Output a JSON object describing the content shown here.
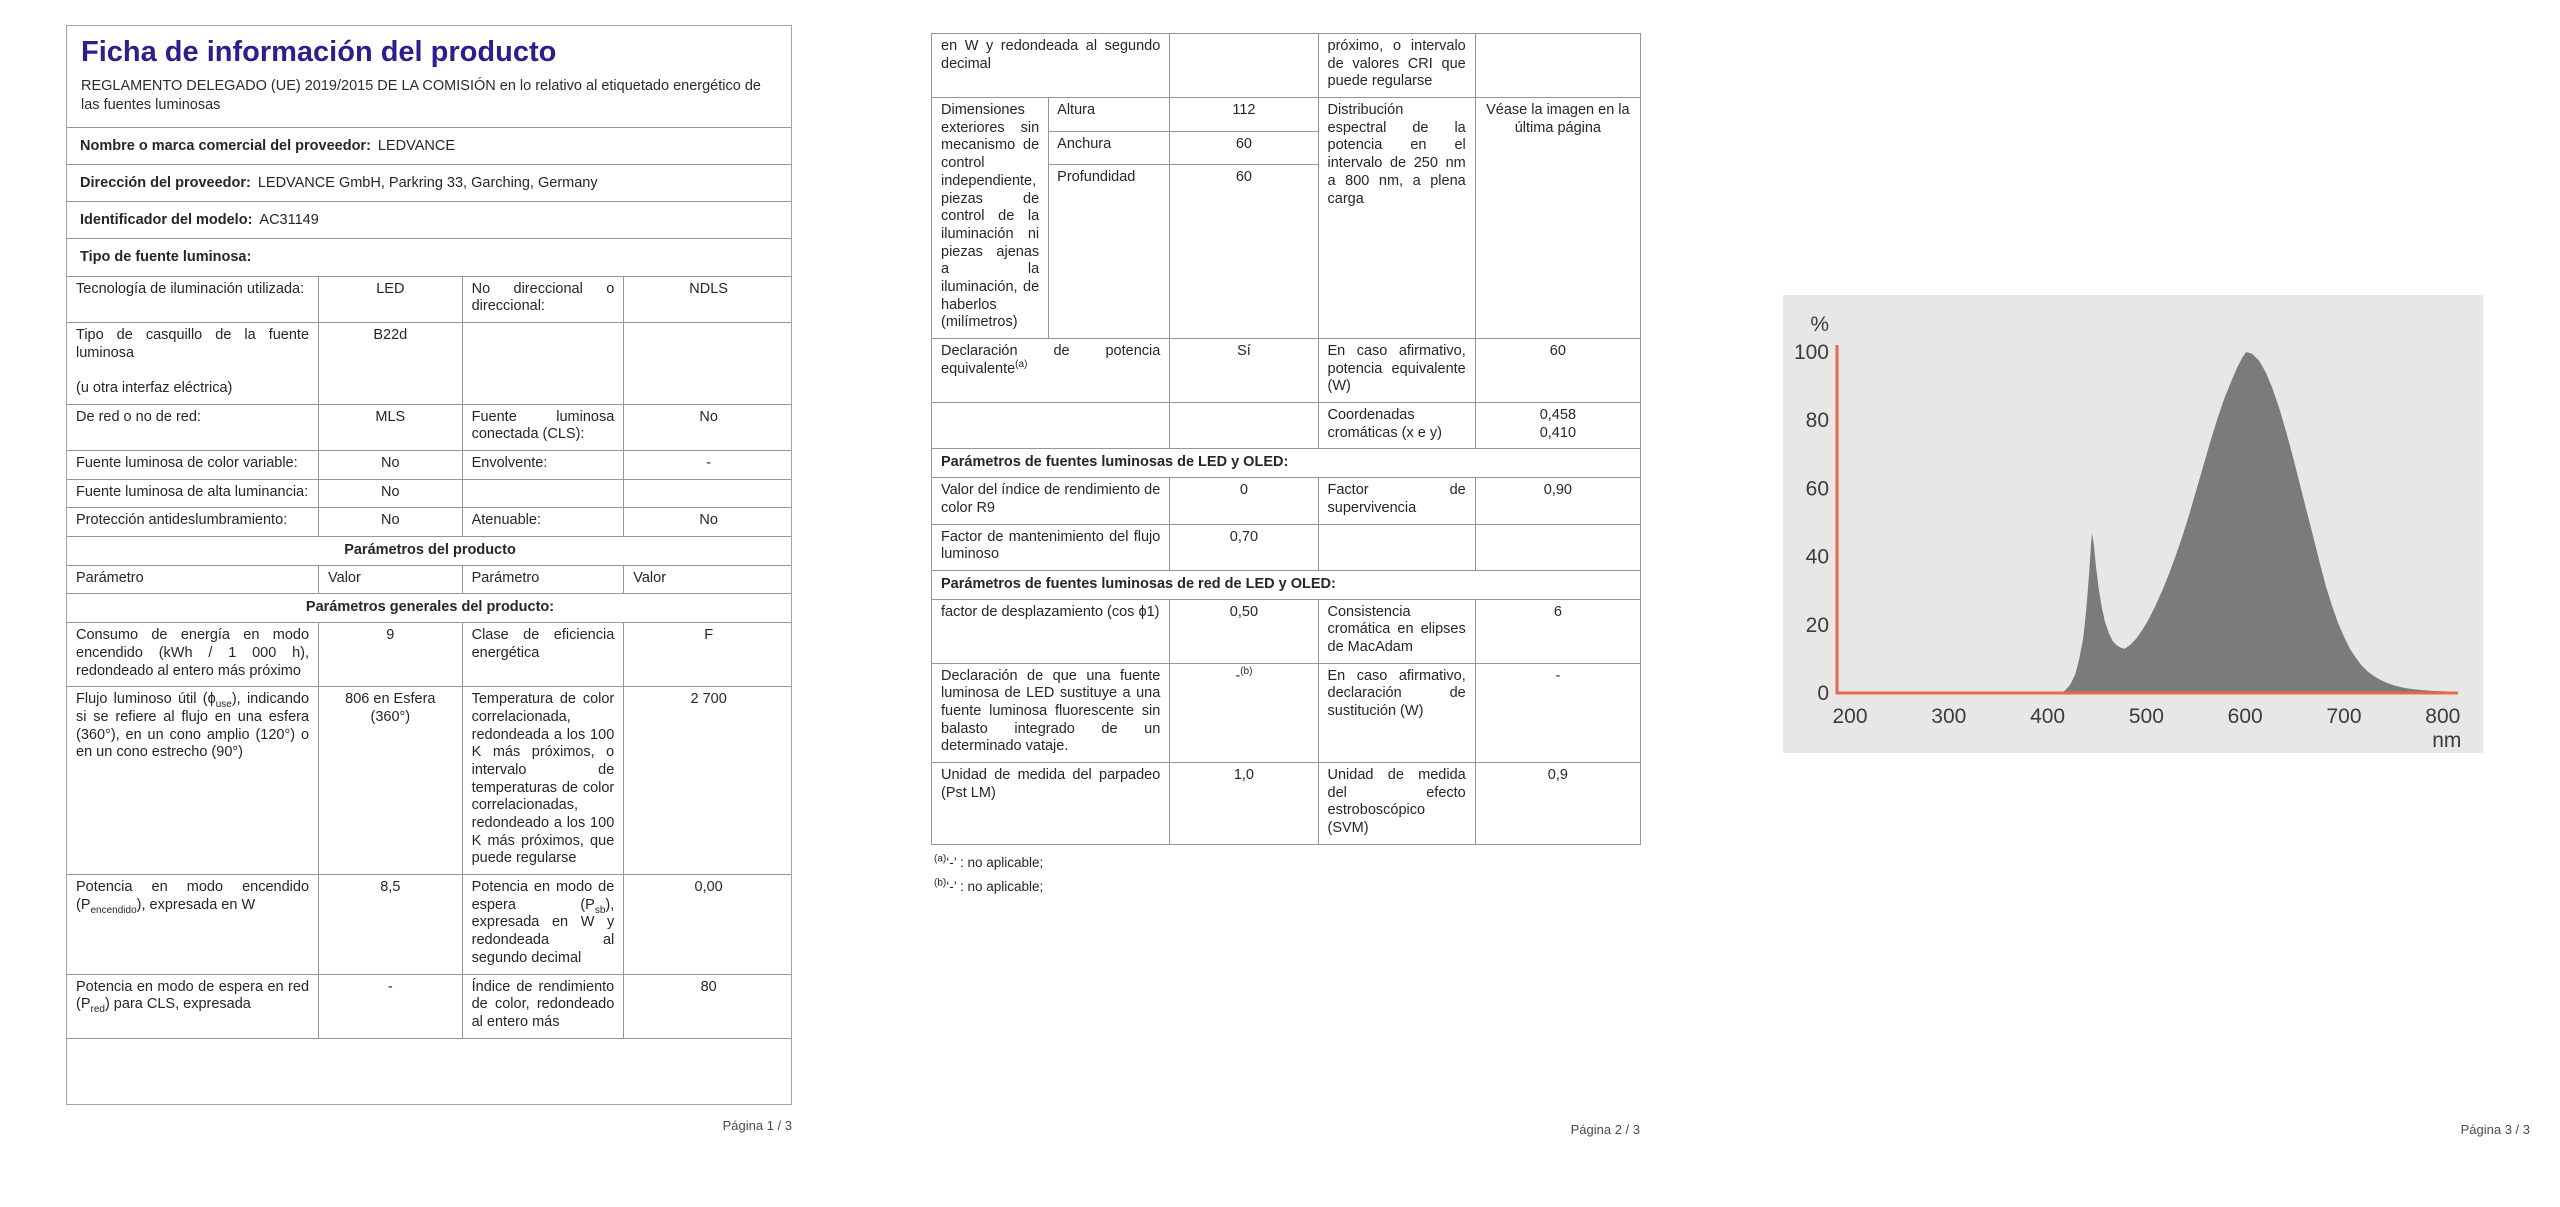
{
  "colors": {
    "title": "#2f1d8e",
    "chart_axis": "#e6694f",
    "chart_fill": "#7b7b7b",
    "chart_panel_bg": "#e8e7e5",
    "table_border": "#969696"
  },
  "page1": {
    "title": "Ficha de información del producto",
    "subtitle": "REGLAMENTO DELEGADO (UE) 2019/2015 DE LA COMISIÓN en lo relativo al etiquetado energético de las fuentes luminosas",
    "info": [
      {
        "label": "Nombre o marca comercial del proveedor:",
        "value": "LEDVANCE"
      },
      {
        "label": "Dirección del proveedor:",
        "value": "LEDVANCE GmbH, Parkring 33, Garching, Germany"
      },
      {
        "label": "Identificador del modelo:",
        "value": "AC31149"
      },
      {
        "label": "Tipo de fuente luminosa:",
        "value": ""
      }
    ],
    "table": {
      "r1": {
        "p1": "Tecnología de iluminación utilizada:",
        "v1": "LED",
        "p2": "No direccional o direccional:",
        "v2": "NDLS"
      },
      "r2": {
        "p1": "Tipo de casquillo de la fuente luminosa\n\n(u otra interfaz eléctrica)",
        "v1": "B22d",
        "p2": "",
        "v2": ""
      },
      "r3": {
        "p1": "De red o no de red:",
        "v1": "MLS",
        "p2": "Fuente luminosa conectada (CLS):",
        "v2": "No"
      },
      "r4": {
        "p1": "Fuente luminosa de color variable:",
        "v1": "No",
        "p2": "Envolvente:",
        "v2": "-"
      },
      "r5": {
        "p1": "Fuente luminosa de alta luminancia:",
        "v1": "No",
        "p2": "",
        "v2": ""
      },
      "r6": {
        "p1": "Protección antideslumbramiento:",
        "v1": "No",
        "p2": "Atenuable:",
        "v2": "No"
      },
      "band1": "Parámetros del producto",
      "hdr": {
        "p1": "Parámetro",
        "v1": "Valor",
        "p2": "Parámetro",
        "v2": "Valor"
      },
      "band2": "Parámetros generales del producto:",
      "r7": {
        "p1": "Consumo de energía en modo encendido (kWh / 1 000 h), redondeado al entero más próximo",
        "v1": "9",
        "p2": "Clase de eficiencia energética",
        "v2": "F"
      },
      "r8": {
        "p1_pre": "Flujo luminoso útil (ϕ",
        "p1_sub": "use",
        "p1_post": "), indicando si se refiere al flujo en una esfera (360°), en un cono amplio (120°) o en un cono estrecho (90°)",
        "v1": "806 en Esfera (360°)",
        "p2": "Temperatura de color correlacionada, redondeada a los 100 K más próximos, o intervalo de temperaturas de color correlacionadas, redondeado a los 100 K más próximos, que puede regularse",
        "v2": "2 700"
      },
      "r9": {
        "p1_pre": "Potencia en modo encendido (P",
        "p1_sub": "encendido",
        "p1_post": "), expresada en W",
        "v1": "8,5",
        "p2_pre": "Potencia en modo de espera (P",
        "p2_sub": "sb",
        "p2_post": "), expresada en W y redondeada al segundo decimal",
        "v2": "0,00"
      },
      "r10": {
        "p1_pre": "Potencia en modo de espera en red (P",
        "p1_sub": "red",
        "p1_post": ") para CLS, expresada",
        "v1": "-",
        "p2": "Índice de rendimiento de color, redondeado al entero más",
        "v2": "80"
      }
    },
    "footer": "Página 1 / 3"
  },
  "page2": {
    "table": {
      "rA": {
        "p1": "en W y redondeada al segundo decimal",
        "v1": "",
        "p2": "próximo, o intervalo de valores CRI que puede regularse",
        "v2": ""
      },
      "rB": {
        "p1": "Dimensiones exteriores sin mecanismo de control independiente, piezas de control de la iluminación ni piezas ajenas a la iluminación, de haberlos (milímetros)",
        "dims": [
          {
            "label": "Altura",
            "value": "112"
          },
          {
            "label": "Anchura",
            "value": "60"
          },
          {
            "label": "Profundidad",
            "value": "60"
          }
        ],
        "p2": "Distribución espectral de la potencia en el intervalo de 250 nm a 800 nm, a plena carga",
        "v2": "Véase la imagen en la última página"
      },
      "rC": {
        "p1": "Declaración de potencia equivalente",
        "p1_sup": "(a)",
        "v1": "Sí",
        "p2": "En caso afirmativo, potencia equivalente (W)",
        "v2": "60"
      },
      "rD": {
        "p1": "",
        "v1": "",
        "p2": "Coordenadas cromáticas (x e y)",
        "v2": "0,458\n0,410"
      },
      "band1": "Parámetros de fuentes luminosas de LED y OLED:",
      "rE": {
        "p1": "Valor del índice de rendimiento de color R9",
        "v1": "0",
        "p2": "Factor de supervivencia",
        "v2": "0,90"
      },
      "rF": {
        "p1": "Factor de mantenimiento del flujo luminoso",
        "v1": "0,70",
        "p2": "",
        "v2": ""
      },
      "band2": "Parámetros de fuentes luminosas de red de LED y OLED:",
      "rG": {
        "p1": "factor de desplazamiento (cos ϕ1)",
        "v1": "0,50",
        "p2": "Consistencia cromática en elipses de MacAdam",
        "v2": "6"
      },
      "rH": {
        "p1": "Declaración de que una fuente luminosa de LED sustituye a una fuente luminosa fluorescente sin balasto integrado de un determinado vataje.",
        "v1": "-",
        "v1_sup": "(b)",
        "p2": "En caso afirmativo, declaración de sustitución (W)",
        "v2": "-"
      },
      "rI": {
        "p1": "Unidad de medida del parpadeo (Pst LM)",
        "v1": "1,0",
        "p2": "Unidad de medida del efecto estroboscópico (SVM)",
        "v2": "0,9"
      }
    },
    "footnotes": [
      {
        "sup": "(a)",
        "text": "‘-’ : no aplicable;"
      },
      {
        "sup": "(b)",
        "text": "‘-’ : no aplicable;"
      }
    ],
    "footer": "Página 2 / 3"
  },
  "page3": {
    "footer": "Página 3 / 3"
  },
  "chart_data": {
    "type": "area",
    "title": "Distribución espectral de la potencia (250 nm a 800 nm, a plena carga)",
    "xlabel": "nm",
    "ylabel": "%",
    "x_ticks": [
      200,
      300,
      400,
      500,
      600,
      700,
      800
    ],
    "y_ticks": [
      0,
      20,
      40,
      60,
      80,
      100
    ],
    "xlim": [
      190,
      815
    ],
    "ylim": [
      0,
      104
    ],
    "grid": false,
    "legend": null,
    "points": [
      [
        413,
        0
      ],
      [
        418,
        0.8
      ],
      [
        423,
        2.5
      ],
      [
        428,
        5.5
      ],
      [
        432,
        10
      ],
      [
        436,
        16
      ],
      [
        439,
        24
      ],
      [
        442,
        35
      ],
      [
        444,
        44
      ],
      [
        445,
        47
      ],
      [
        447,
        43
      ],
      [
        449,
        37
      ],
      [
        452,
        30
      ],
      [
        455,
        25
      ],
      [
        458,
        21
      ],
      [
        462,
        17.5
      ],
      [
        466,
        15.2
      ],
      [
        470,
        14
      ],
      [
        474,
        13.3
      ],
      [
        478,
        13
      ],
      [
        484,
        14.2
      ],
      [
        490,
        16
      ],
      [
        496,
        18.5
      ],
      [
        502,
        21.5
      ],
      [
        509,
        25.5
      ],
      [
        516,
        30
      ],
      [
        523,
        35
      ],
      [
        530,
        40.5
      ],
      [
        537,
        46.5
      ],
      [
        544,
        53
      ],
      [
        551,
        60
      ],
      [
        558,
        67
      ],
      [
        565,
        74
      ],
      [
        572,
        80.5
      ],
      [
        579,
        86.5
      ],
      [
        586,
        91.5
      ],
      [
        592,
        95.5
      ],
      [
        597,
        98.3
      ],
      [
        601,
        100
      ],
      [
        607,
        99.5
      ],
      [
        614,
        97.5
      ],
      [
        621,
        94
      ],
      [
        628,
        89
      ],
      [
        635,
        83
      ],
      [
        642,
        76
      ],
      [
        649,
        68.5
      ],
      [
        656,
        60.5
      ],
      [
        663,
        52.5
      ],
      [
        670,
        44.5
      ],
      [
        676,
        37.5
      ],
      [
        682,
        31
      ],
      [
        688,
        25.5
      ],
      [
        694,
        20.5
      ],
      [
        700,
        16.5
      ],
      [
        706,
        13
      ],
      [
        712,
        10.3
      ],
      [
        718,
        8
      ],
      [
        724,
        6.3
      ],
      [
        730,
        5
      ],
      [
        737,
        3.8
      ],
      [
        744,
        2.9
      ],
      [
        751,
        2.2
      ],
      [
        758,
        1.7
      ],
      [
        766,
        1.3
      ],
      [
        774,
        1
      ],
      [
        782,
        0.8
      ],
      [
        791,
        0.6
      ],
      [
        800,
        0.5
      ],
      [
        808,
        0.4
      ]
    ]
  }
}
